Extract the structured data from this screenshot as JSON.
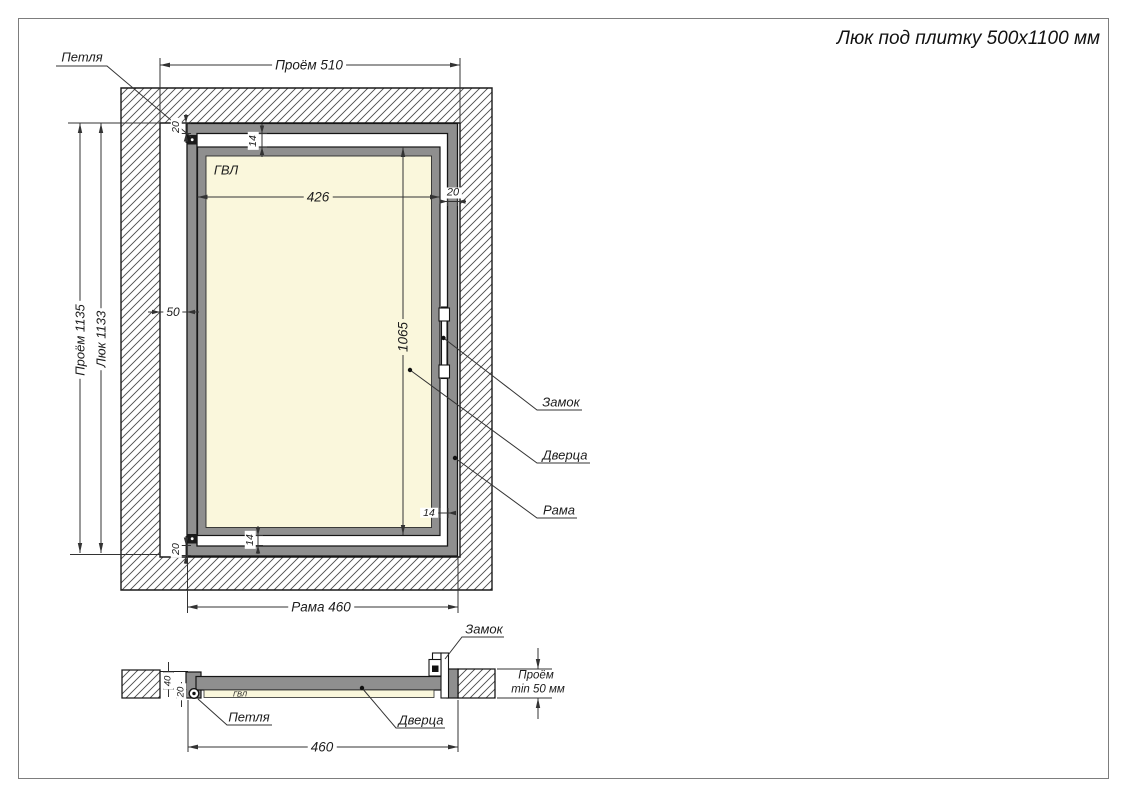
{
  "title": "Люк под плитку 500х1100 мм",
  "colors": {
    "frame_gray": "#8f8f8f",
    "panel_cream": "#FAF7DC",
    "line": "#1a1a1a"
  },
  "front": {
    "labels": {
      "hinge": "Петля",
      "panel": "ГВЛ",
      "lock": "Замок",
      "door": "Дверца",
      "frame": "Рама"
    },
    "dims": {
      "opening_width": "Проём 510",
      "opening_height": "Проём 1135",
      "hatch_height": "Люк 1133",
      "panel_width": "426",
      "panel_height": "1065",
      "frame_width": "Рама 460",
      "offset_left": "50",
      "profile_top": "20",
      "profile_right": "20",
      "profile_bottom": "20",
      "gap_top": "14",
      "gap_bottom": "14",
      "gap_right": "14"
    }
  },
  "section": {
    "labels": {
      "lock": "Замок",
      "hinge": "Петля",
      "door": "Дверца",
      "panel": "ГВЛ"
    },
    "dims": {
      "frame_width": "460",
      "depth": "40",
      "panel_thickness": "20",
      "opening_depth_1": "Проём",
      "opening_depth_2": "min 50 мм"
    }
  }
}
